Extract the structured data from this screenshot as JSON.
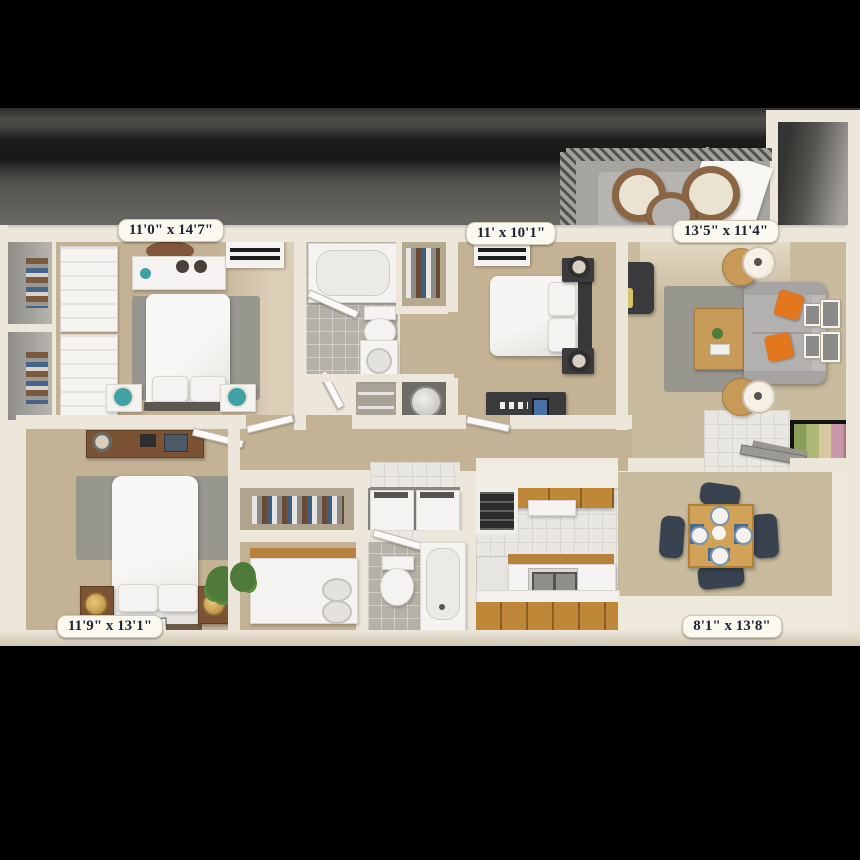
{
  "scene": {
    "description": "3D top-down apartment floor plan render, two-bedroom-plus-den unit with balcony",
    "unit_labels": {
      "bedroom_top_left": "11'0\" x 14'7\"",
      "bedroom_middle": "11' x 10'1\"",
      "living_room": "13'5\" x 11'4\"",
      "bedroom_bottom_left": "11'9\" x 13'1\"",
      "kitchen_dining": "8'1\" x 13'8\""
    },
    "colors": {
      "backdrop": "#000000",
      "backdrop_band": "#5A5854",
      "wall": "#EDE6DA",
      "carpet": "#C4B294",
      "area_rug": "#98978F",
      "bath_tile": "#B6B1A8",
      "kitchen_tile": "#E9E7E1",
      "cabinet_wood": "#BE8838",
      "table_wood": "#C89A58",
      "sofa_gray": "#B3B1AF",
      "accent_pillow_orange": "#E2771E",
      "dining_chair_navy": "#39434F",
      "accent_teal": "#3FA1A3",
      "plant_green": "#4E7A3A",
      "label_text": "#1D2433",
      "label_background": "#FBF8F0"
    }
  }
}
